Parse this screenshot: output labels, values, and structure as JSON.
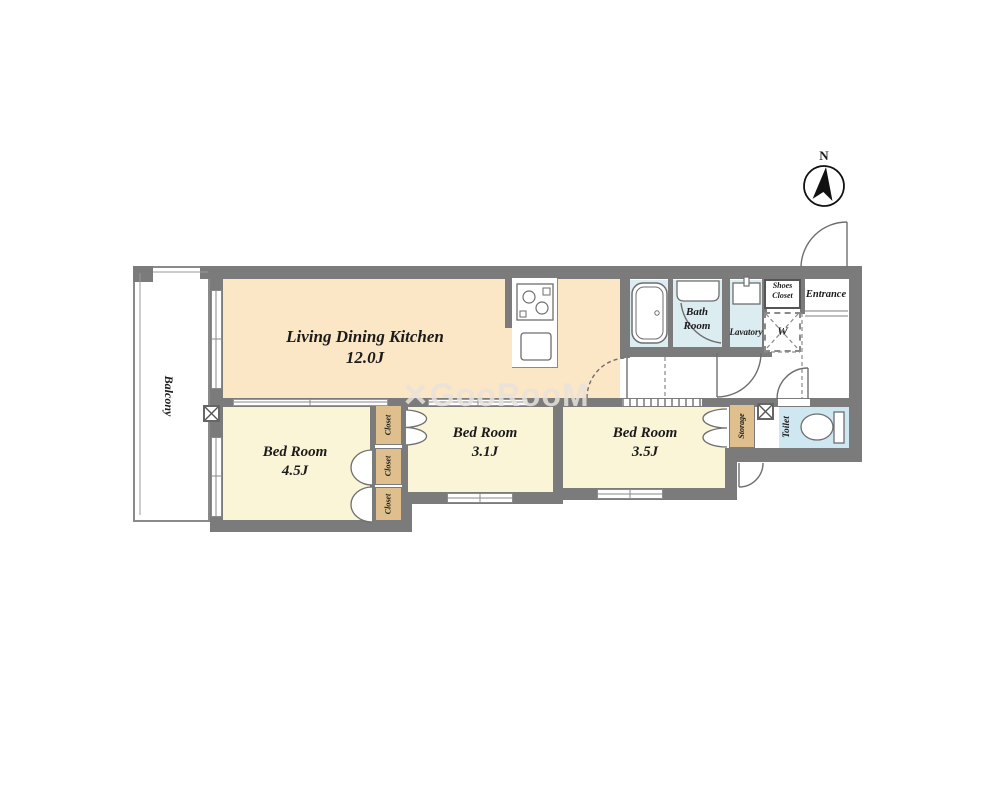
{
  "colors": {
    "wall": "#7b7b7b",
    "ldk": "#fbe6c5",
    "room": "#faf5d7",
    "closet": "#debf8d",
    "wet": "#dcedf1",
    "wet2": "#cfe7f0"
  },
  "watermark": "✕GooRooM",
  "compass": {
    "label": "N"
  },
  "rooms": {
    "ldk": {
      "name": "Living Dining Kitchen",
      "size": "12.0J"
    },
    "bedroom_45": {
      "name": "Bed Room",
      "size": "4.5J"
    },
    "bedroom_31": {
      "name": "Bed Room",
      "size": "3.1J"
    },
    "bedroom_35": {
      "name": "Bed Room",
      "size": "3.5J"
    },
    "bath": {
      "name": "Bath Room"
    },
    "lavatory": {
      "name": "Lavatory"
    },
    "toilet": {
      "name": "Toilet"
    },
    "entrance": {
      "name": "Entrance"
    },
    "shoes_closet": {
      "name": "Shoes Closet"
    },
    "washer_space": {
      "name": "W"
    },
    "storage": {
      "name": "Storage"
    },
    "closet1": {
      "name": "Closet"
    },
    "closet2": {
      "name": "Closet"
    },
    "closet3": {
      "name": "Closet"
    },
    "balcony": {
      "name": "Balcony"
    }
  }
}
